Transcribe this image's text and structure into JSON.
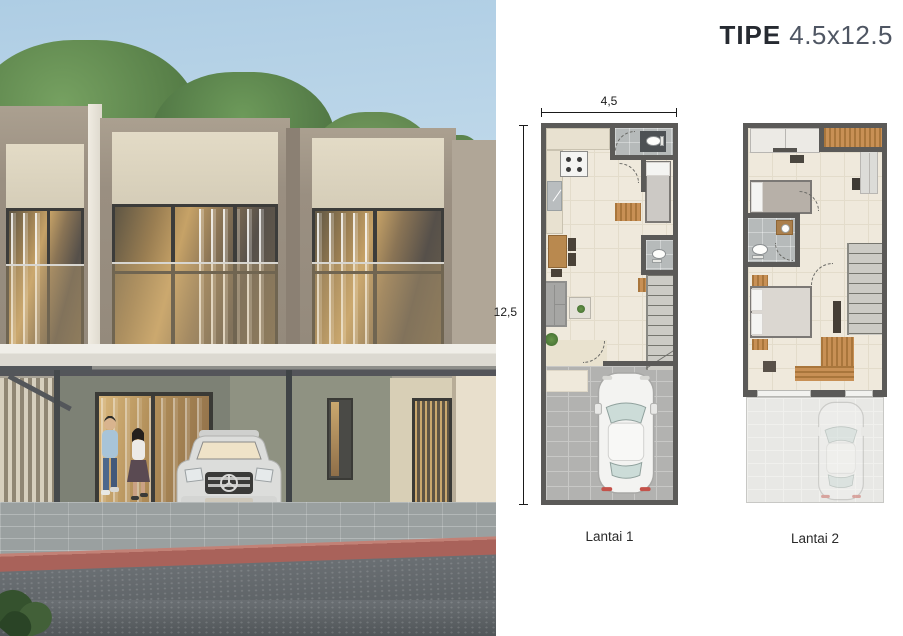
{
  "title": {
    "bold": "TIPE",
    "size": "4.5x12.5"
  },
  "floorplan": {
    "dim_width": "4,5",
    "dim_height": "12,5",
    "floor1": {
      "label": "Lantai 1"
    },
    "floor2": {
      "label": "Lantai 2"
    }
  },
  "colors": {
    "wall": "#5b5a58",
    "floor_cream": "#efe9dc",
    "bath_tile": "#b6baba",
    "wood_accent": "#c08a4e",
    "title_dark": "#262a31",
    "title_gray": "#4f5663",
    "curb_red": "#a9625a",
    "asphalt": "#585d62"
  },
  "scene": {
    "photo": "two-storey-townhouse-exterior",
    "people": "couple-walking",
    "vehicle": "silver-suv-parked"
  }
}
